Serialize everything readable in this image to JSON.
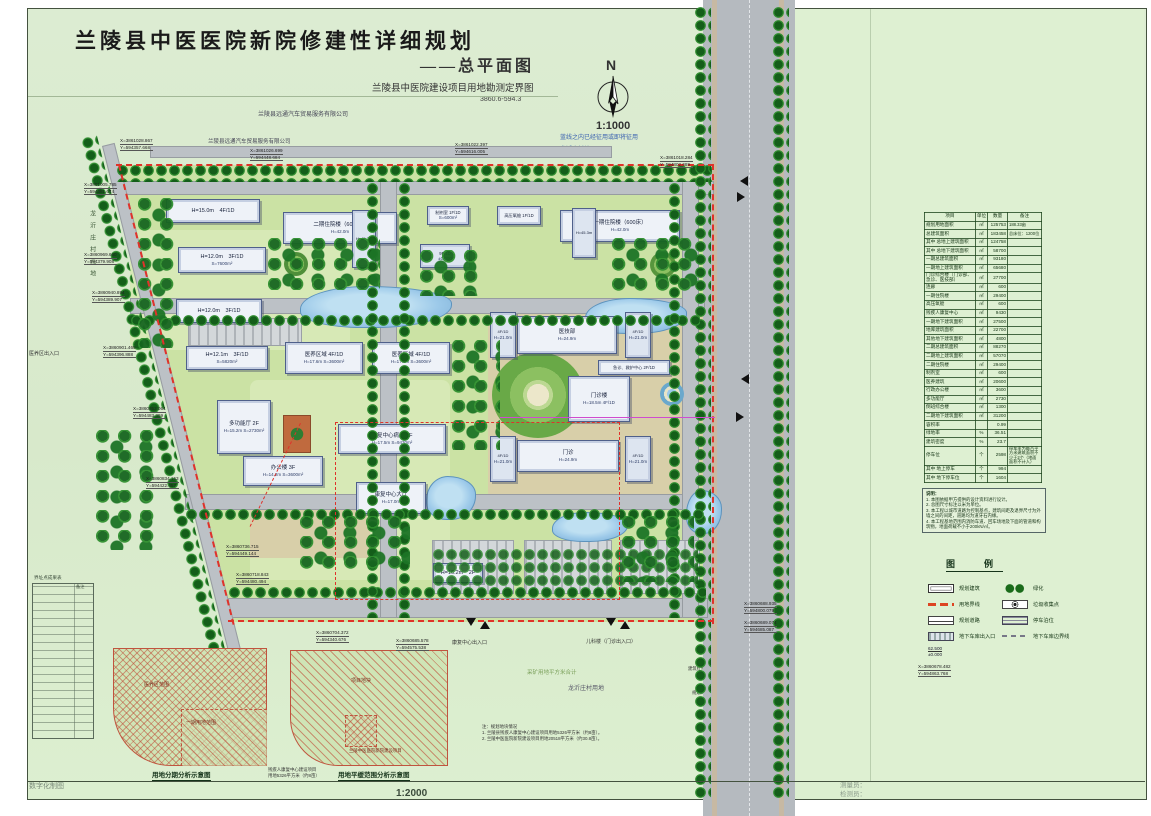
{
  "title": {
    "main": "兰陵县中医医院新院修建性详细规划",
    "sub": "——总平面图",
    "sub2": "兰陵县中医院建设项目用地勘测定界图",
    "sub3": "3860.6-594.3"
  },
  "compass": {
    "n": "N",
    "scale": "1:1000"
  },
  "colors": {
    "boundary_red": "#e0322a",
    "road_gray": "#b5babf",
    "tree_green": "#1d6d1f",
    "pond_blue": "#9cc9e9",
    "site_green": "#cbe2a4"
  },
  "road_name": {
    "c0": "泉",
    "c1": "山",
    "c2": "路"
  },
  "map_texts": {
    "company1": "兰陵县远通汽车贸易服务有限公司",
    "company2": "兰陵县远通汽车贸易服务有限公司",
    "blue1": "蓝线之内已经征用或即将征用",
    "blue2": "龙沂庄村地",
    "village_left": "龙沂庄村荒地",
    "yy_exit": "医养区出入口",
    "mine": "采矿用地平方米合计",
    "village2": "龙沂庄村用地",
    "pond1": "浅水",
    "pond2": "浅水",
    "bl": "建筑红线",
    "gl": "规划绿线",
    "rl": "道路红线",
    "clc": "道路中心线",
    "swk": "人行道",
    "d1": "10.00",
    "d2": "25.00",
    "d3": "25.00",
    "w1": "41.36",
    "w2": "82.00"
  },
  "entrances": {
    "secondary": "医院次出入口",
    "main": "医院主出入口",
    "rehab": "康复中心出入口",
    "pediatric": "儿科楼（门诊出入口）"
  },
  "coords": [
    {
      "x": "X=3861028.867",
      "y": "Y=594357.668"
    },
    {
      "x": "X=3861026.699",
      "y": "Y=594448.684"
    },
    {
      "x": "X=3861022.397",
      "y": "Y=594616.005"
    },
    {
      "x": "X=3861018.284",
      "y": "Y=594802.689"
    },
    {
      "x": "X=3861005.785",
      "y": "Y=594381.674"
    },
    {
      "x": "X=3860969.660",
      "y": "Y=594379.908"
    },
    {
      "x": "X=3860940.894",
      "y": "Y=594389.907"
    },
    {
      "x": "X=3860901.469",
      "y": "Y=594396.888"
    },
    {
      "x": "X=3860852.064",
      "y": "Y=594483.399"
    },
    {
      "x": "X=3860834.153",
      "y": "Y=594422.457"
    },
    {
      "x": "X=3860736.715",
      "y": "Y=594449.144"
    },
    {
      "x": "X=3860718.843",
      "y": "Y=594480.494"
    },
    {
      "x": "X=3860704.372",
      "y": "Y=594340.676"
    },
    {
      "x": "X=3860685.578",
      "y": "Y=594575.538"
    },
    {
      "x": "X=3860688.935",
      "y": "Y=594800.079"
    },
    {
      "x": "X=3860689.074",
      "y": "Y=594685.087"
    }
  ],
  "buildings": [
    {
      "label": "H=15.0m　4F/1D",
      "sub": ""
    },
    {
      "label": "H=12.0m　3F/1D",
      "sub": "S=7600m²"
    },
    {
      "label": "H=12.0m　3F/1D",
      "sub": ""
    },
    {
      "label": "H=12.1m　3F/1D",
      "sub": "S=5820m²"
    },
    {
      "label": "二期住院楼（600床）",
      "sub": "H=42.0m"
    },
    {
      "label": "H=45.3m",
      "sub": ""
    },
    {
      "label": "制剂室 1F/1D",
      "sub": "S=600m²"
    },
    {
      "label": "高压氧舱 1F/1D",
      "sub": ""
    },
    {
      "label": "9F/1D",
      "sub": "±0.000"
    },
    {
      "label": "一期住院楼（600床）",
      "sub": "H=42.0m"
    },
    {
      "label": "H=45.3m",
      "sub": ""
    },
    {
      "label": "医技部",
      "sub": "H=24.9m"
    },
    {
      "label": "4F/1D",
      "sub": "H=21.0m"
    },
    {
      "label": "4F/1D",
      "sub": "H=21.0m"
    },
    {
      "label": "急诊、救护中心 2F/1D",
      "sub": ""
    },
    {
      "label": "门诊楼",
      "sub": "H=18.5m 4F/1D"
    },
    {
      "label": "门诊",
      "sub": "H=24.9m"
    },
    {
      "label": "4F/1D",
      "sub": "H=21.0m"
    },
    {
      "label": "4F/1D",
      "sub": "H=21.0m"
    },
    {
      "label": "医养区域 4F/1D",
      "sub": "H=17.6m S=3600m²"
    },
    {
      "label": "医养区域 4F/1D",
      "sub": "H=17.6m S=3600m²"
    },
    {
      "label": "多功能厅 2F",
      "sub": "H=15.2m S=2730m²"
    },
    {
      "label": "办公楼 3F",
      "sub": "H=14.2m S=3600m²"
    },
    {
      "label": "康复中心病房 4F",
      "sub": "H=17.5m S=9430m²"
    },
    {
      "label": "康复中心大厅",
      "sub": "H=17.0m"
    },
    {
      "label": "H=16.2m　2F",
      "sub": ""
    }
  ],
  "indicators": {
    "title": "经济技术指标：",
    "headers": [
      "项目",
      "单位",
      "数量",
      "备注"
    ],
    "rows": [
      {
        "c": "规划用地面积",
        "u": "㎡",
        "q": "125753",
        "n": "188.33亩",
        "cls": "cl"
      },
      {
        "c": "总建筑面积",
        "u": "㎡",
        "q": "183458",
        "n": "总床位：1200位",
        "cls": "cl"
      },
      {
        "c": "其中 总地上建筑面积",
        "u": "㎡",
        "q": "124758",
        "n": "",
        "cls": "cl i1"
      },
      {
        "c": "其中 总地下建筑面积",
        "u": "㎡",
        "q": "58700",
        "n": "",
        "cls": "cl i1"
      },
      {
        "c": "一期总建筑面积",
        "u": "㎡",
        "q": "93180",
        "n": "",
        "cls": "cl"
      },
      {
        "c": "一期地上建筑面积",
        "u": "㎡",
        "q": "65680",
        "n": "",
        "cls": "cl i1"
      },
      {
        "c": "门诊综合楼（门诊部、急诊、医技部）",
        "u": "㎡",
        "q": "27700",
        "n": "",
        "cls": "cl i2"
      },
      {
        "c": "连廊",
        "u": "㎡",
        "q": "600",
        "n": "",
        "cls": "cl i2"
      },
      {
        "c": "一期住院楼",
        "u": "㎡",
        "q": "29400",
        "n": "",
        "cls": "cl i2"
      },
      {
        "c": "高压氧舱",
        "u": "㎡",
        "q": "600",
        "n": "",
        "cls": "cl i2"
      },
      {
        "c": "残疾人康复中心",
        "u": "㎡",
        "q": "9430",
        "n": "",
        "cls": "cl i2"
      },
      {
        "c": "一期地下建筑面积",
        "u": "㎡",
        "q": "27500",
        "n": "",
        "cls": "cl i1"
      },
      {
        "c": "地库建筑面积",
        "u": "㎡",
        "q": "22700",
        "n": "",
        "cls": "cl i2"
      },
      {
        "c": "其他地下建筑面积",
        "u": "㎡",
        "q": "4800",
        "n": "",
        "cls": "cl i2"
      },
      {
        "c": "二期总建筑面积",
        "u": "㎡",
        "q": "88270",
        "n": "",
        "cls": "cl"
      },
      {
        "c": "二期地上建筑面积",
        "u": "㎡",
        "q": "57070",
        "n": "",
        "cls": "cl i1"
      },
      {
        "c": "二期住院楼",
        "u": "㎡",
        "q": "29400",
        "n": "",
        "cls": "cl i2"
      },
      {
        "c": "制剂室",
        "u": "㎡",
        "q": "600",
        "n": "",
        "cls": "cl i2"
      },
      {
        "c": "医养建筑",
        "u": "㎡",
        "q": "20600",
        "n": "",
        "cls": "cl i2"
      },
      {
        "c": "行政办公楼",
        "u": "㎡",
        "q": "3600",
        "n": "",
        "cls": "cl i2"
      },
      {
        "c": "多功能厅",
        "u": "㎡",
        "q": "2730",
        "n": "",
        "cls": "cl i2"
      },
      {
        "c": "倒班综合楼",
        "u": "㎡",
        "q": "1300",
        "n": "",
        "cls": "cl i2"
      },
      {
        "c": "二期地下建筑面积",
        "u": "㎡",
        "q": "31200",
        "n": "",
        "cls": "cl i1"
      },
      {
        "c": "容积率",
        "u": "",
        "q": "0.99",
        "n": "",
        "cls": "cl"
      },
      {
        "c": "绿地率",
        "u": "%",
        "q": "36.51",
        "n": "",
        "cls": "cl"
      },
      {
        "c": "建筑密度",
        "u": "%",
        "q": "23.7",
        "n": "",
        "cls": "cl"
      },
      {
        "c": "停车位",
        "u": "个",
        "q": "2598",
        "n": "停车率为每百平方米建筑面积不少于2个（地面面积不计入）",
        "cls": "cl"
      },
      {
        "c": "其中 地上停车",
        "u": "个",
        "q": "994",
        "n": "",
        "cls": "cl i1"
      },
      {
        "c": "其中 地下停车位",
        "u": "个",
        "q": "1604",
        "n": "",
        "cls": "cl i1"
      }
    ]
  },
  "notes": {
    "title": "说明：",
    "items": [
      "1. 本图依据甲方提供的设计资料进行设计。",
      "2. 总图尺寸标注以米为单位。",
      "3. 本工程以城市道路为控制基点，建筑间距及退界尺寸为外墙之间的间距，道路均为道牙石内缘。",
      "4. 本工程基地范围内消防车道、回车场地及下面的管道和构筑物，地面荷载不小于200kN/㎡。"
    ]
  },
  "legend": {
    "title": "图　例",
    "col1": [
      {
        "sw": "sw sw-bldg",
        "label": "规划建筑"
      },
      {
        "sw": "sw sw-bound",
        "label": "用地界线"
      },
      {
        "sw": "sw sw-road",
        "label": "规划道路"
      },
      {
        "sw": "sw sw-ramp",
        "label": "地下车库出入口"
      }
    ],
    "col2": [
      {
        "sw": "sw sw-green",
        "label": "绿化"
      },
      {
        "sw": "sw sw-trash",
        "label": "垃圾收集点"
      },
      {
        "sw": "sw sw-park",
        "label": "停车泊位"
      },
      {
        "sw": "sw sw-garage",
        "label": "地下车库边界线"
      }
    ]
  },
  "elev": {
    "top": "62.500",
    "bot": "±0.000",
    "label": "建筑±0.000的绝对高程"
  },
  "corner_coord": {
    "x": "X=3860678.482",
    "y": "Y=594863.768",
    "label": "建筑外角定位坐标（含条基座）"
  },
  "insets": {
    "left_title": "用地分期分析示意图",
    "left_l1": "医养区范围",
    "left_l2": "一期用地范围",
    "right_title": "用地平缓范围分析示意图",
    "right_l1": "项目地块",
    "right_l2": "兰陵中医医院新院建设项目",
    "leader": "残疾人康复中心建设项目",
    "leader2": "用地5326平方米（约8亩）",
    "scale": "1:2000"
  },
  "plan_note": {
    "title": "注：规划地块情况",
    "l1": "1. 兰陵县残疾人康复中心建设项目用地5326平方米（约8亩）。",
    "l2": "2. 兰陵中医医院新院建设项目用地20518平方米（约30.8亩）。"
  },
  "left_table": {
    "title": "界址点成果表",
    "header": "备注"
  },
  "footer": {
    "cad": "数字化制图",
    "surveyor": "测量员：",
    "checker": "检测员："
  }
}
